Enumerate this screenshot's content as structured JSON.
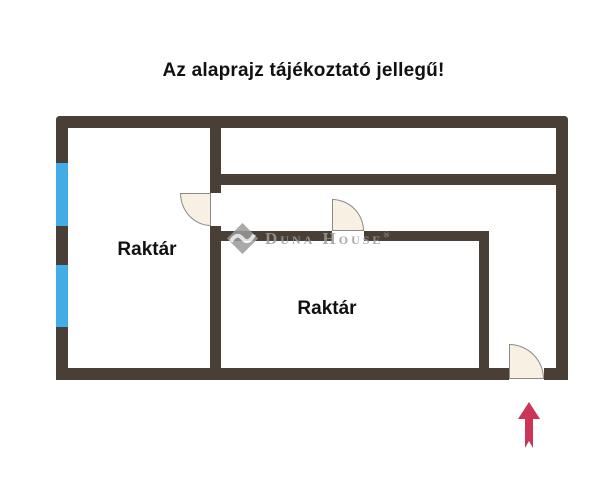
{
  "title": "Az alaprajz tájékoztató jellegű!",
  "rooms": [
    {
      "label": "Raktár"
    },
    {
      "label": "Raktár"
    }
  ],
  "watermark": {
    "brand": "Duna House",
    "registered": "®"
  },
  "features": {
    "windows": "2 window segments on left exterior wall",
    "doors": "3 door swing arcs",
    "entrance_marker": "red up arrow at bottom-right entrance"
  },
  "colors": {
    "wall": "#4a3f37",
    "window": "#41ace8",
    "door-fill": "#f7f0e3",
    "door-stroke": "#8a8a8a",
    "arrow": "#cb3557",
    "ink": "#111111",
    "watermark": "#9b9b9b",
    "bg": "#ffffff"
  }
}
